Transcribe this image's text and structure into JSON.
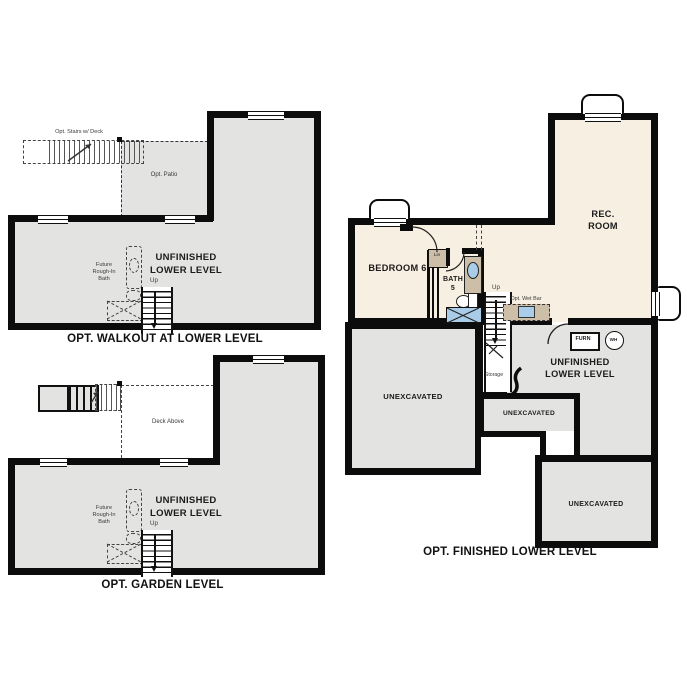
{
  "title": "Lower level floor plan options",
  "colors": {
    "wall": "#0c0c0c",
    "unfinished_fill": "#e3e3e1",
    "finished_fill": "#f7efe2",
    "cabinet_tan": "#cdbfa7",
    "fixture_blue": "#a9cde8"
  },
  "shared": {
    "unfinished_lower_level": "UNFINISHED\nLOWER LEVEL",
    "unexcavated": "UNEXCAVATED",
    "up": "Up",
    "future_bath": "Future\nRough-In\nBath"
  },
  "plans": {
    "walkout": {
      "caption": "OPT. WALKOUT AT LOWER LEVEL",
      "opt_stairs": "Opt. Stairs w/ Deck",
      "opt_patio": "Opt. Patio"
    },
    "garden": {
      "caption": "OPT. GARDEN LEVEL",
      "deck_above": "Deck Above"
    },
    "finished": {
      "caption": "OPT. FINISHED LOWER LEVEL",
      "rec_room": "REC.\nROOM",
      "bedroom6": "BEDROOM 6",
      "bath5": "BATH\n5",
      "lin": "Lin",
      "storage": "Storage",
      "opt_wet_bar": "Opt. Wet Bar",
      "furn": "FURN",
      "wh": "WH"
    }
  }
}
